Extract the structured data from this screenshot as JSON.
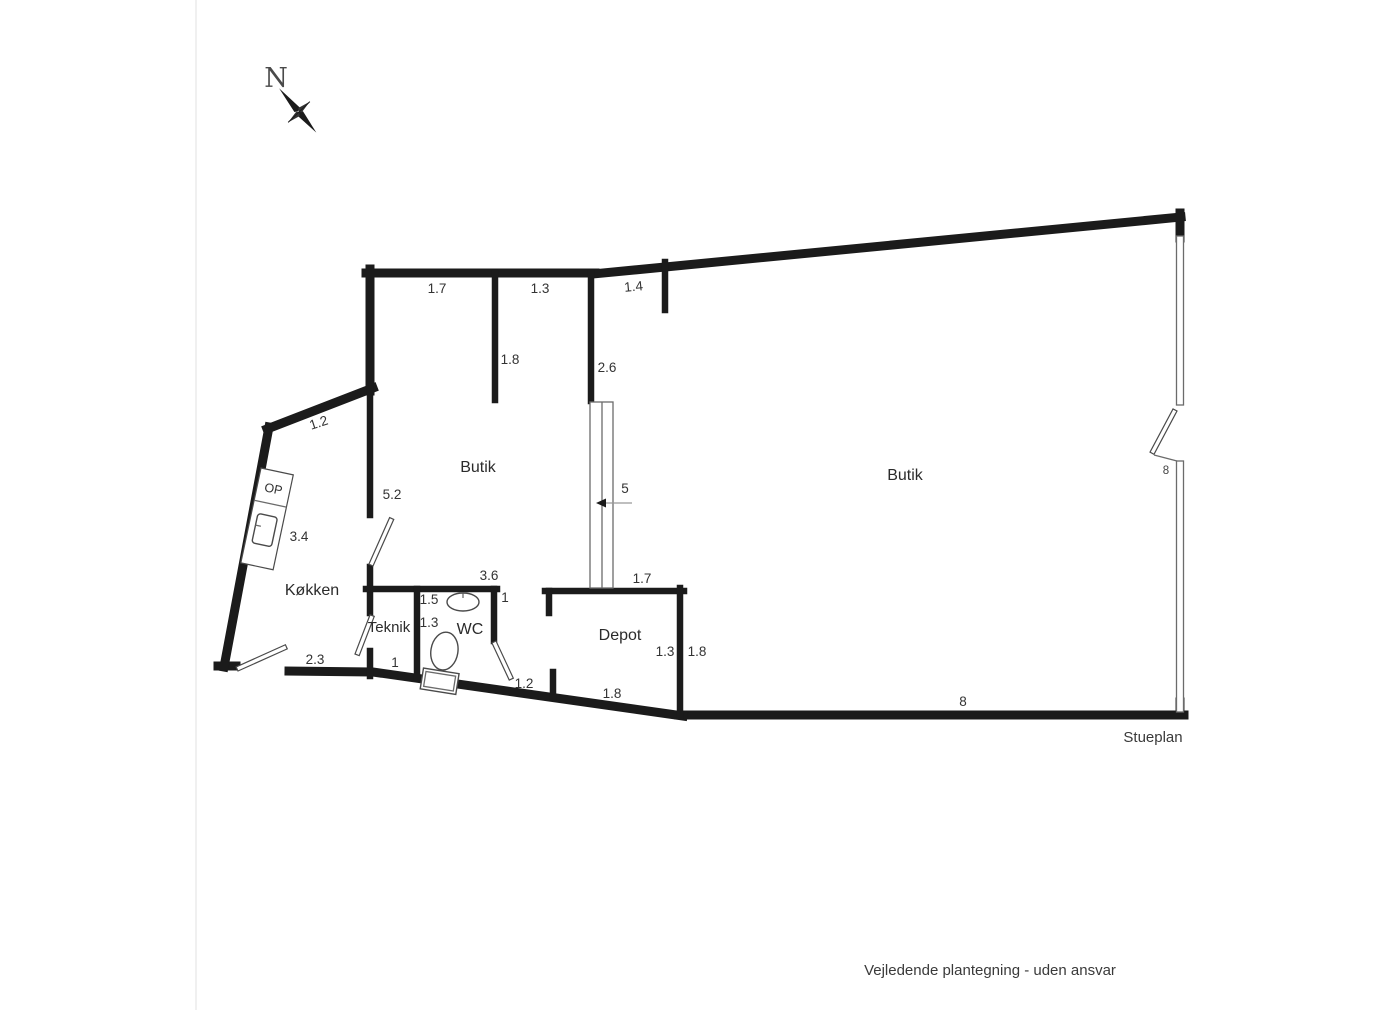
{
  "document": {
    "plan_label": "Stueplan",
    "disclaimer": "Vejledende plantegning - uden ansvar"
  },
  "compass": {
    "north_label": "N"
  },
  "rooms": {
    "butik_left": "Butik",
    "butik_right": "Butik",
    "koekken": "Køkken",
    "teknik": "Teknik",
    "wc": "WC",
    "depot": "Depot"
  },
  "kitchen_counter": {
    "label": "OP"
  },
  "stairs": {
    "width_label": "5"
  },
  "measurements": {
    "top_wall_left": "1.7",
    "top_wall_right": "1.3",
    "top_wall_angled": "1.4",
    "butik_divider_wall": "1.8",
    "stair_wall": "2.6",
    "koekken_top_diagonal": "1.2",
    "koekken_butik_wall": "5.2",
    "counter_length": "3.4",
    "koekken_bottom": "2.3",
    "teknik_bottom": "1",
    "wc_left_upper": "1.5",
    "wc_left_lower": "1.3",
    "wc_top": "3.6",
    "wc_top_right": "1",
    "wc_door_bottom": "1.2",
    "depot_top": "1.7",
    "depot_right_inner": "1.3",
    "depot_right_outer": "1.8",
    "depot_bottom": "1.8",
    "bottom_wall": "8",
    "right_wall_window": "8"
  },
  "colors": {
    "background": "#ffffff",
    "wall": "#1b1b1b",
    "thin_line": "#6b6b6b",
    "text": "#333333"
  }
}
